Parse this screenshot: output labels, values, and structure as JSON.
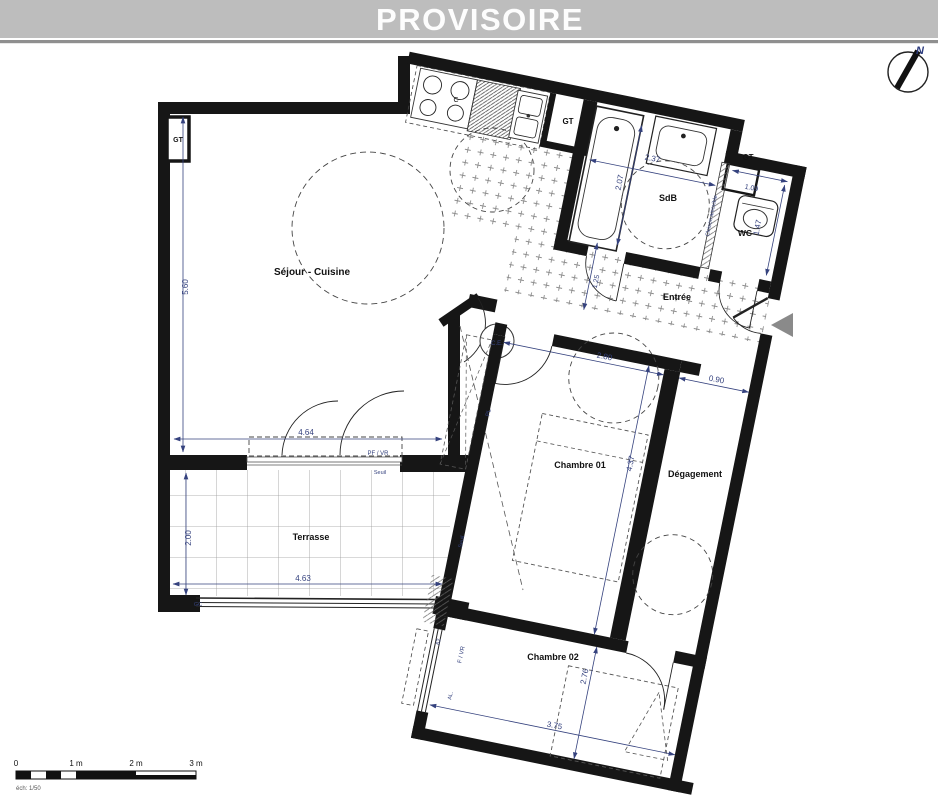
{
  "header": {
    "title": "PROVISOIRE"
  },
  "compass": {
    "north_label": "N"
  },
  "plan": {
    "rooms": {
      "sejour": "Séjour - Cuisine",
      "sdb": "SdB",
      "wc": "WC",
      "entree": "Entrée",
      "chambre1": "Chambre 01",
      "degagement": "Dégagement",
      "chambre2": "Chambre 02",
      "terrasse": "Terrasse"
    },
    "dims": {
      "sejour_h": "5.60",
      "sejour_w": "4.64",
      "terrasse_h": "2.00",
      "terrasse_w": "4.63",
      "sdb_w": "2.37",
      "sdb_h": "2.07",
      "wc_w": "1.09",
      "wc_h": "1.47",
      "entree_w": "1.25",
      "chambre1_w": "2.80",
      "degagement_w": "0.90",
      "chambre1_h": "4.37",
      "chambre2_h": "2.76",
      "chambre2_w": "3.75"
    },
    "annot": {
      "gt": "GT",
      "cooktop": "C",
      "water_heater": "C.E.",
      "closet": "PL",
      "pf_vr": "PF / VR",
      "seuil": "Seuil",
      "cloison": "Cloison amovible",
      "f_vr": "F / VR",
      "al": "AL.",
      "gc": "GC",
      "w62": "62"
    }
  },
  "scale_bar": {
    "tick0": "0",
    "tick1": "1 m",
    "tick2": "2 m",
    "tick3": "3 m",
    "caption": "éch: 1/50"
  }
}
